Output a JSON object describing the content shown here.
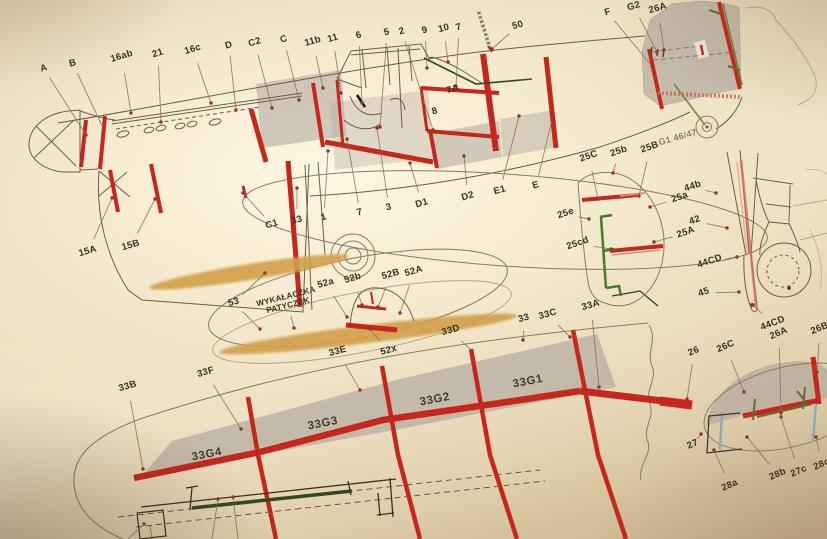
{
  "diagram": {
    "description_colors": {
      "paper": "#e9dcbd",
      "former_red": "#c5271d",
      "shading_gray": "#b4aba1",
      "propeller_amber": "#d2a049",
      "hinge_green": "#4a7a28",
      "detail_olive": "#5d7030",
      "strut_blue": "#8fa8ba",
      "ink": "#3b2f24",
      "leader_line": "#8a6e52"
    },
    "labels": [
      {
        "text": "A",
        "x": 44,
        "y": 69,
        "r": -17,
        "to": [
          [
            86,
            135
          ]
        ]
      },
      {
        "text": "B",
        "x": 73,
        "y": 64,
        "r": -17,
        "to": [
          [
            104,
            130
          ]
        ]
      },
      {
        "text": "16ab",
        "x": 122,
        "y": 57,
        "r": -17,
        "to": [
          [
            131,
            113
          ]
        ]
      },
      {
        "text": "21",
        "x": 158,
        "y": 54,
        "r": -17,
        "to": [
          [
            161,
            122
          ]
        ]
      },
      {
        "text": "16c",
        "x": 193,
        "y": 50,
        "r": -17,
        "to": [
          [
            211,
            103
          ]
        ]
      },
      {
        "text": "D",
        "x": 229,
        "y": 46,
        "r": -17,
        "to": [
          [
            236,
            110
          ]
        ]
      },
      {
        "text": "C2",
        "x": 255,
        "y": 43,
        "r": -17,
        "to": [
          [
            272,
            108
          ]
        ]
      },
      {
        "text": "C",
        "x": 284,
        "y": 40,
        "r": -17,
        "to": [
          [
            299,
            100
          ]
        ]
      },
      {
        "text": "11b",
        "x": 313,
        "y": 42,
        "to": [
          [
            323,
            88
          ]
        ]
      },
      {
        "text": "11",
        "x": 333,
        "y": 39,
        "to": [
          [
            341,
            93
          ]
        ]
      },
      {
        "text": "6",
        "x": 359,
        "y": 36,
        "to": [
          [
            362,
            103
          ]
        ]
      },
      {
        "text": "5",
        "x": 387,
        "y": 33,
        "to": [
          [
            380,
            127
          ]
        ]
      },
      {
        "text": "2",
        "x": 402,
        "y": 32,
        "to": [
          [
            433,
            130
          ]
        ]
      },
      {
        "text": "9",
        "x": 425,
        "y": 31,
        "to": [
          [
            427,
            68
          ]
        ]
      },
      {
        "text": "10",
        "x": 444,
        "y": 29,
        "to": [
          [
            448,
            62
          ]
        ]
      },
      {
        "text": "7",
        "x": 459,
        "y": 28,
        "to": [
          [
            456,
            86
          ]
        ]
      },
      {
        "text": "50",
        "x": 518,
        "y": 26,
        "to": [
          [
            492,
            49
          ]
        ]
      },
      {
        "text": "F",
        "x": 608,
        "y": 13,
        "to": [
          [
            652,
            66
          ]
        ]
      },
      {
        "text": "G2",
        "x": 634,
        "y": 7,
        "to": [
          [
            657,
            52
          ]
        ]
      },
      {
        "text": "26A",
        "x": 658,
        "y": 9,
        "to": [
          [
            664,
            50
          ]
        ]
      },
      {
        "text": "7A",
        "x": 453,
        "y": 90
      },
      {
        "text": "8",
        "x": 435,
        "y": 112
      },
      {
        "text": "G1 46/47",
        "x": 678,
        "y": 138
      },
      {
        "text": "C1",
        "x": 272,
        "y": 225,
        "to": [
          [
            243,
            193
          ]
        ]
      },
      {
        "text": "33",
        "x": 297,
        "y": 221,
        "to": [
          [
            297,
            188
          ]
        ]
      },
      {
        "text": "1",
        "x": 324,
        "y": 218,
        "to": [
          [
            328,
            151
          ]
        ]
      },
      {
        "text": "7",
        "x": 360,
        "y": 213,
        "to": [
          [
            347,
            139
          ]
        ]
      },
      {
        "text": "3",
        "x": 389,
        "y": 208,
        "to": [
          [
            377,
            128
          ]
        ]
      },
      {
        "text": "D1",
        "x": 422,
        "y": 204,
        "to": [
          [
            410,
            163
          ]
        ]
      },
      {
        "text": "D2",
        "x": 468,
        "y": 197,
        "to": [
          [
            464,
            156
          ]
        ]
      },
      {
        "text": "E1",
        "x": 500,
        "y": 191,
        "to": [
          [
            519,
            116
          ]
        ]
      },
      {
        "text": "E",
        "x": 536,
        "y": 186,
        "to": [
          [
            552,
            120
          ]
        ]
      },
      {
        "text": "15A",
        "x": 88,
        "y": 252,
        "to": [
          [
            112,
            198
          ]
        ]
      },
      {
        "text": "15B",
        "x": 131,
        "y": 246,
        "to": [
          [
            155,
            199
          ]
        ]
      },
      {
        "text": "25C",
        "x": 589,
        "y": 157,
        "r": -19,
        "to": [
          [
            598,
            199
          ]
        ]
      },
      {
        "text": "25b",
        "x": 619,
        "y": 152,
        "r": -19,
        "to": [
          [
            613,
            173
          ]
        ]
      },
      {
        "text": "25B",
        "x": 650,
        "y": 148,
        "r": -19,
        "to": [
          [
            639,
            196
          ]
        ]
      },
      {
        "text": "25a",
        "x": 680,
        "y": 198,
        "r": -19,
        "to": [
          [
            650,
            207
          ]
        ]
      },
      {
        "text": "25e",
        "x": 566,
        "y": 214,
        "r": -19,
        "to": [
          [
            589,
            219
          ]
        ]
      },
      {
        "text": "25A",
        "x": 686,
        "y": 233,
        "r": -19,
        "to": [
          [
            654,
            242
          ]
        ]
      },
      {
        "text": "25cd",
        "x": 578,
        "y": 244,
        "r": -19,
        "to": [
          [
            611,
            249
          ]
        ]
      },
      {
        "text": "44b",
        "x": 693,
        "y": 187,
        "r": -19,
        "to": [
          [
            716,
            193
          ]
        ]
      },
      {
        "text": "42",
        "x": 695,
        "y": 221,
        "r": -19,
        "to": [
          [
            727,
            228
          ]
        ]
      },
      {
        "text": "44CD",
        "x": 710,
        "y": 262,
        "r": -19,
        "to": [
          [
            737,
            257
          ]
        ]
      },
      {
        "text": "45",
        "x": 704,
        "y": 293,
        "r": -19,
        "to": [
          [
            739,
            292
          ]
        ]
      },
      {
        "text": "44CD",
        "x": 773,
        "y": 324,
        "r": -21,
        "to": [
          [
            753,
            305
          ]
        ]
      },
      {
        "text": "53",
        "x": 234,
        "y": 303,
        "to": [
          [
            265,
            273
          ],
          [
            260,
            329
          ]
        ]
      },
      {
        "text": "WYKAŁACZKA\nPATYCZEK",
        "x": 287,
        "y": 301,
        "r": -14,
        "to": [
          [
            294,
            328
          ]
        ]
      },
      {
        "text": "52a",
        "x": 326,
        "y": 284,
        "to": [
          [
            347,
            317
          ]
        ]
      },
      {
        "text": "52b",
        "x": 353,
        "y": 279,
        "to": [
          [
            362,
            305
          ]
        ]
      },
      {
        "text": "52B",
        "x": 391,
        "y": 275,
        "to": [
          [
            378,
            307
          ]
        ]
      },
      {
        "text": "52A",
        "x": 414,
        "y": 272,
        "to": [
          [
            400,
            313
          ]
        ]
      },
      {
        "text": "52x",
        "x": 389,
        "y": 351,
        "to": [
          [
            370,
            329
          ]
        ]
      },
      {
        "text": "33E",
        "x": 338,
        "y": 352,
        "to": [
          [
            360,
            390
          ]
        ]
      },
      {
        "text": "33D",
        "x": 451,
        "y": 331,
        "to": [
          [
            472,
            351
          ]
        ]
      },
      {
        "text": "33",
        "x": 524,
        "y": 319,
        "to": [
          [
            523,
            340
          ]
        ]
      },
      {
        "text": "33C",
        "x": 548,
        "y": 315,
        "to": [
          [
            570,
            337
          ]
        ]
      },
      {
        "text": "33A",
        "x": 591,
        "y": 306,
        "to": [
          [
            599,
            387
          ]
        ]
      },
      {
        "text": "33B",
        "x": 128,
        "y": 387,
        "to": [
          [
            143,
            469
          ]
        ]
      },
      {
        "text": "33F",
        "x": 206,
        "y": 373,
        "to": [
          [
            241,
            429
          ]
        ]
      },
      {
        "text": "33G4",
        "x": 207,
        "y": 455,
        "r": -11
      },
      {
        "text": "33G3",
        "x": 323,
        "y": 424,
        "r": -11
      },
      {
        "text": "33G2",
        "x": 435,
        "y": 400,
        "r": -11
      },
      {
        "text": "33G1",
        "x": 528,
        "y": 382,
        "r": -11
      },
      {
        "text": "26",
        "x": 694,
        "y": 352,
        "r": -23,
        "to": [
          [
            687,
            399
          ]
        ]
      },
      {
        "text": "26C",
        "x": 726,
        "y": 347,
        "r": -23,
        "to": [
          [
            744,
            392
          ]
        ]
      },
      {
        "text": "26A",
        "x": 779,
        "y": 334,
        "r": -23,
        "to": [
          [
            781,
            413
          ]
        ]
      },
      {
        "text": "26B",
        "x": 820,
        "y": 329,
        "r": -23,
        "to": [
          [
            817,
            372
          ]
        ]
      },
      {
        "text": "27",
        "x": 693,
        "y": 445,
        "r": -23,
        "to": [
          [
            701,
            434
          ]
        ]
      },
      {
        "text": "28a",
        "x": 730,
        "y": 486,
        "r": -23,
        "to": [
          [
            714,
            450
          ]
        ]
      },
      {
        "text": "28b",
        "x": 778,
        "y": 475,
        "r": -23,
        "to": [
          [
            747,
            437
          ]
        ]
      },
      {
        "text": "27c",
        "x": 799,
        "y": 472,
        "r": -23,
        "to": [
          [
            781,
            417
          ]
        ]
      },
      {
        "text": "28c",
        "x": 822,
        "y": 465,
        "r": -23,
        "to": [
          [
            816,
            437
          ]
        ]
      }
    ]
  }
}
